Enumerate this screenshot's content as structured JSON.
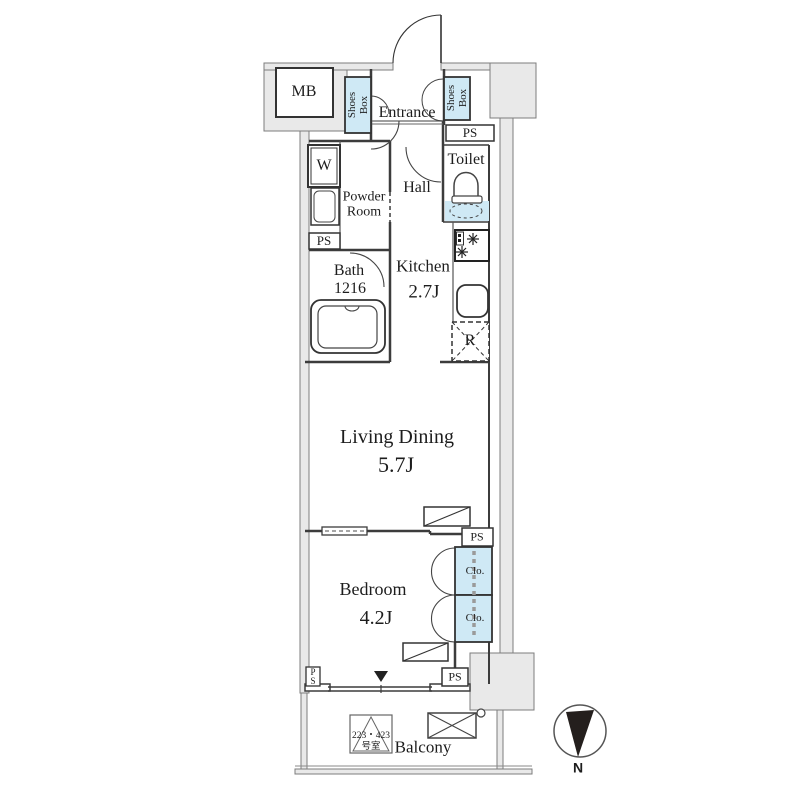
{
  "rooms": {
    "mb": "MB",
    "shoes_box": "Shoes Box",
    "entrance": "Entrance",
    "ps": "PS",
    "toilet": "Toilet",
    "washer": "W",
    "hall": "Hall",
    "powder_room": "Powder Room",
    "bath": {
      "name": "Bath",
      "size": "1216"
    },
    "kitchen": {
      "name": "Kitchen",
      "size": "2.7J"
    },
    "refrigerator": "R",
    "living_dining": {
      "name": "Living Dining",
      "size": "5.7J"
    },
    "bedroom": {
      "name": "Bedroom",
      "size": "4.2J"
    },
    "closet": "Clo.",
    "balcony": "Balcony"
  },
  "annotations": {
    "room_sign": {
      "line1": "223・423",
      "line2": "号室"
    },
    "compass": "N"
  },
  "colors": {
    "fixture_blue": "#cfe9f5",
    "wall_gray": "#e9e9e9",
    "line": "#3c3c3c"
  }
}
